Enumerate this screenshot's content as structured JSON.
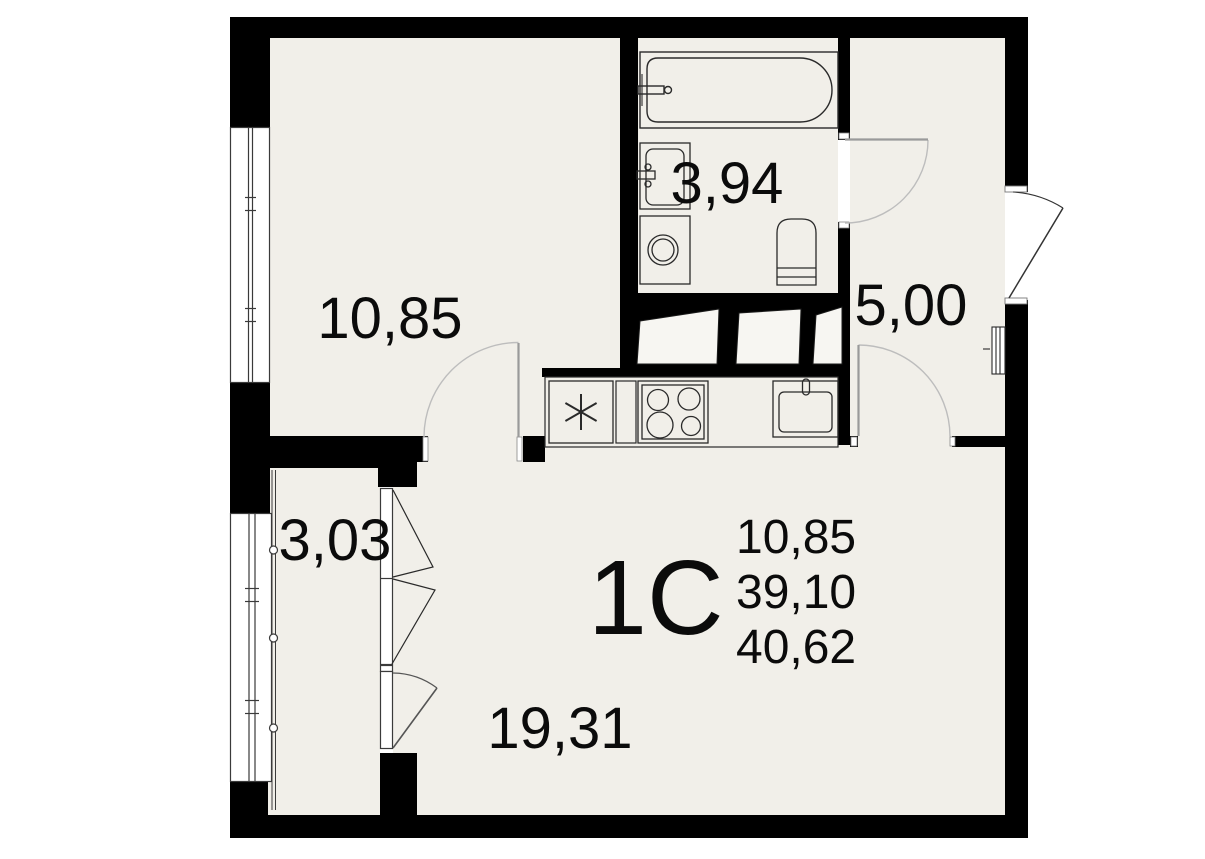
{
  "floorplan": {
    "unit": {
      "type_label": "1С",
      "rooms_area": "10,85",
      "living_area": "39,10",
      "total_area": "40,62"
    },
    "rooms": [
      {
        "id": "room",
        "area": "10,85"
      },
      {
        "id": "bathroom",
        "area": "3,94"
      },
      {
        "id": "hallway",
        "area": "5,00"
      },
      {
        "id": "balcony",
        "area": "3,03"
      },
      {
        "id": "kitchen-living",
        "area": "19,31"
      }
    ],
    "fixtures": [
      "bathtub",
      "bathroom-sink",
      "washing-machine",
      "toilet",
      "fridge",
      "stove",
      "kitchen-sink",
      "vent-shafts",
      "electric-panel"
    ],
    "colors": {
      "wall": "#000000",
      "floor": "#F1EFE9",
      "background": "#FFFFFF",
      "fixture_line": "#2A2A2A",
      "door_arc": "#B5B5B5",
      "door_leaf": "#999999",
      "entry_door_line": "#333333"
    }
  }
}
